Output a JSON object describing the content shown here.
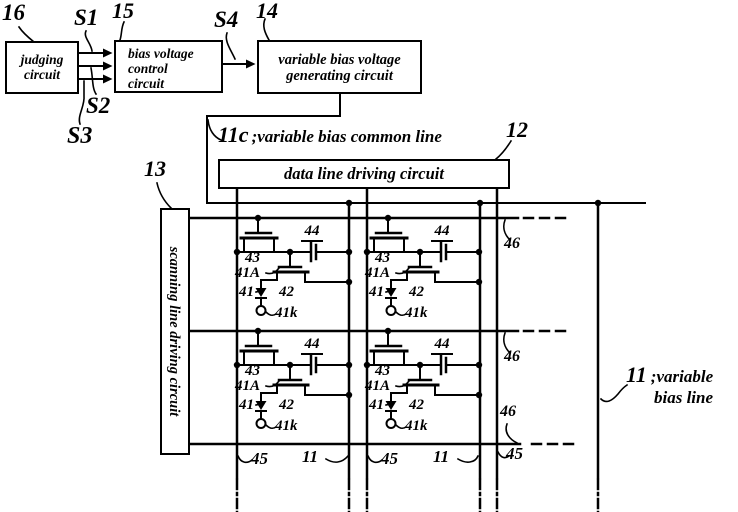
{
  "top_blocks": {
    "ref16": "16",
    "s1": "S1",
    "ref15": "15",
    "s2": "S2",
    "s3": "S3",
    "s4": "S4",
    "ref14": "14",
    "judging": {
      "line1": "judging",
      "line2": "circuit"
    },
    "bias_control": {
      "line1": "bias voltage",
      "line2": "control",
      "line3": "circuit"
    },
    "bias_generator": {
      "line1": "variable bias voltage",
      "line2": "generating circuit"
    }
  },
  "common_line": {
    "ref": "11c",
    "label": ";variable bias common line"
  },
  "data_driver": {
    "ref": "12",
    "label": "data line driving circuit"
  },
  "scan_driver": {
    "ref": "13",
    "label": "scanning line driving circuit"
  },
  "cell": {
    "switch_transistor": "43",
    "capacitor": "44",
    "anode": "41A",
    "el_element": "41",
    "drive_transistor": "42",
    "cathode": "41k"
  },
  "scan_line": {
    "ref": "46"
  },
  "bias_line": {
    "ref": "11",
    "label1": ";variable",
    "label2": "bias line"
  },
  "bottom": {
    "data_line": "45",
    "bias_line": "11"
  }
}
